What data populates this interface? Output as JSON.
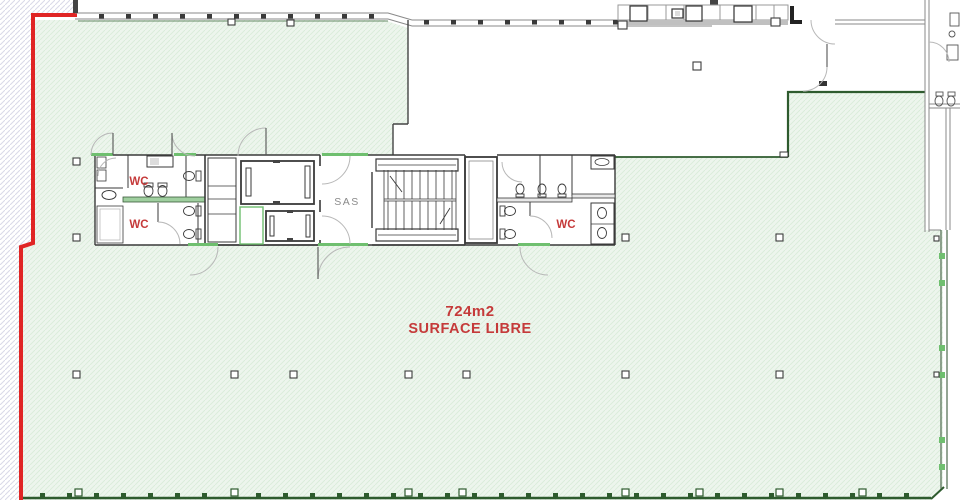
{
  "drawing": {
    "type": "architectural-floor-plan",
    "labels": {
      "area_value": "724m2",
      "area_caption": "SURFACE LIBRE",
      "lobby": "SAS",
      "wc_left_upper": "WC",
      "wc_left_lower": "WC",
      "wc_right": "WC"
    },
    "colors": {
      "boundary_red": "#e02525",
      "label_red": "#c53a3a",
      "floor_fill": "#edf5ed",
      "floor_hatch": "#d9ecd9",
      "border_green": "#2e5b2e",
      "accent_green": "#6fbf6f",
      "wall_dark": "#3a3a3a",
      "wall_light": "#999999",
      "exterior_hatch": "#d9d9e8",
      "label_gray": "#8a8a8a"
    }
  }
}
